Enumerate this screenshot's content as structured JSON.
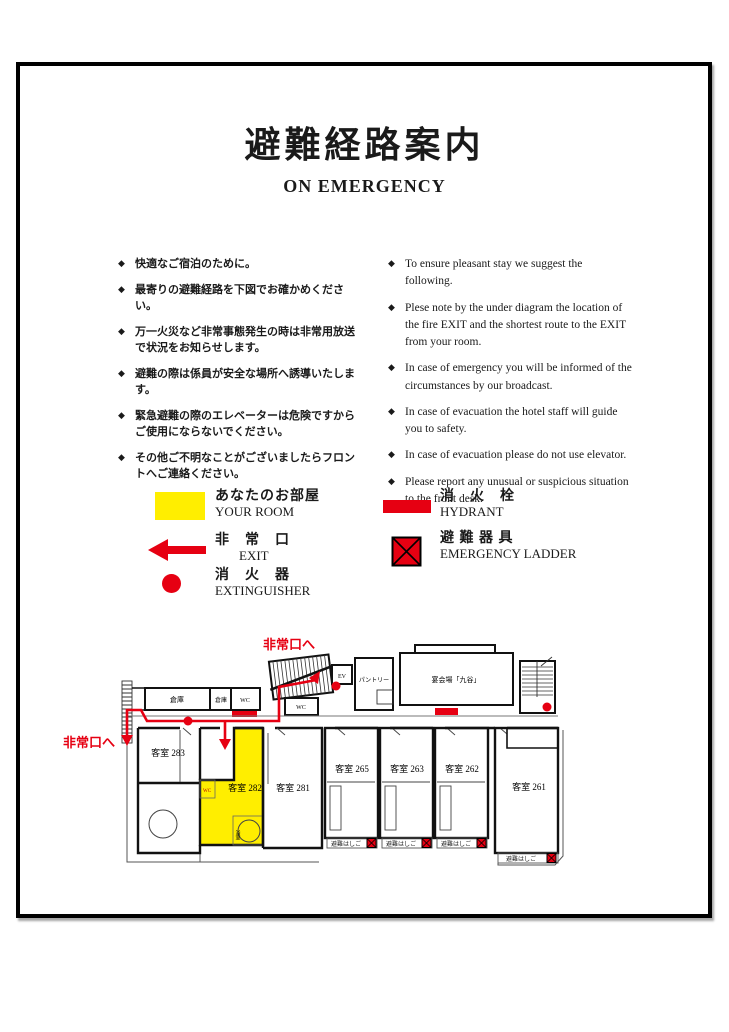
{
  "header": {
    "title": "避難経路案内",
    "subtitle": "ON EMERGENCY"
  },
  "notices_ja": [
    "快適なご宿泊のために。",
    "最寄りの避難経路を下図でお確かめください。",
    "万一火災など非常事態発生の時は非常用放送で状況をお知らせします。",
    "避難の際は係員が安全な場所へ誘導いたします。",
    "緊急避難の際のエレベーターは危険ですからご使用にならないでください。",
    "その他ご不明なことがございましたらフロントへご連絡ください。"
  ],
  "notices_en": [
    "To ensure pleasant stay we suggest the following.",
    "Plese note by the under diagram the location of the fire EXIT and the shortest route to the EXIT from your room.",
    "In case of emergency you will be informed of the circumstances by our broadcast.",
    "In case of evacuation the hotel staff will guide you to safety.",
    "In case of evacuation please do not use elevator.",
    "Please report any unusual or suspicious situation to the front desk."
  ],
  "legend": {
    "your_room_ja": "あなたのお部屋",
    "your_room_en": "YOUR ROOM",
    "exit_ja": "非　常　口",
    "exit_en": "EXIT",
    "extinguisher_ja": "消　火　器",
    "extinguisher_en": "EXTINGUISHER",
    "hydrant_ja": "消　火　栓",
    "hydrant_en": "HYDRANT",
    "ladder_ja": "避 難 器 具",
    "ladder_en": "EMERGENCY LADDER"
  },
  "plan": {
    "exit_left": "非常口へ",
    "exit_top": "非常口へ",
    "storage1": "倉庫",
    "storage2": "倉庫",
    "wc1": "WC",
    "wc2": "WC",
    "wc3": "WC",
    "ev": "EV",
    "pantry": "パントリー",
    "banquet": "宴会場「九谷」",
    "bath": "浴室",
    "ladder": "避難はしご",
    "r283": "客室 283",
    "r282": "客室 282",
    "r281": "客室 281",
    "r265": "客室 265",
    "r263": "客室 263",
    "r262": "客室 262",
    "r261": "客室 261"
  },
  "colors": {
    "red": "#e60012",
    "yellow": "#ffee00"
  }
}
